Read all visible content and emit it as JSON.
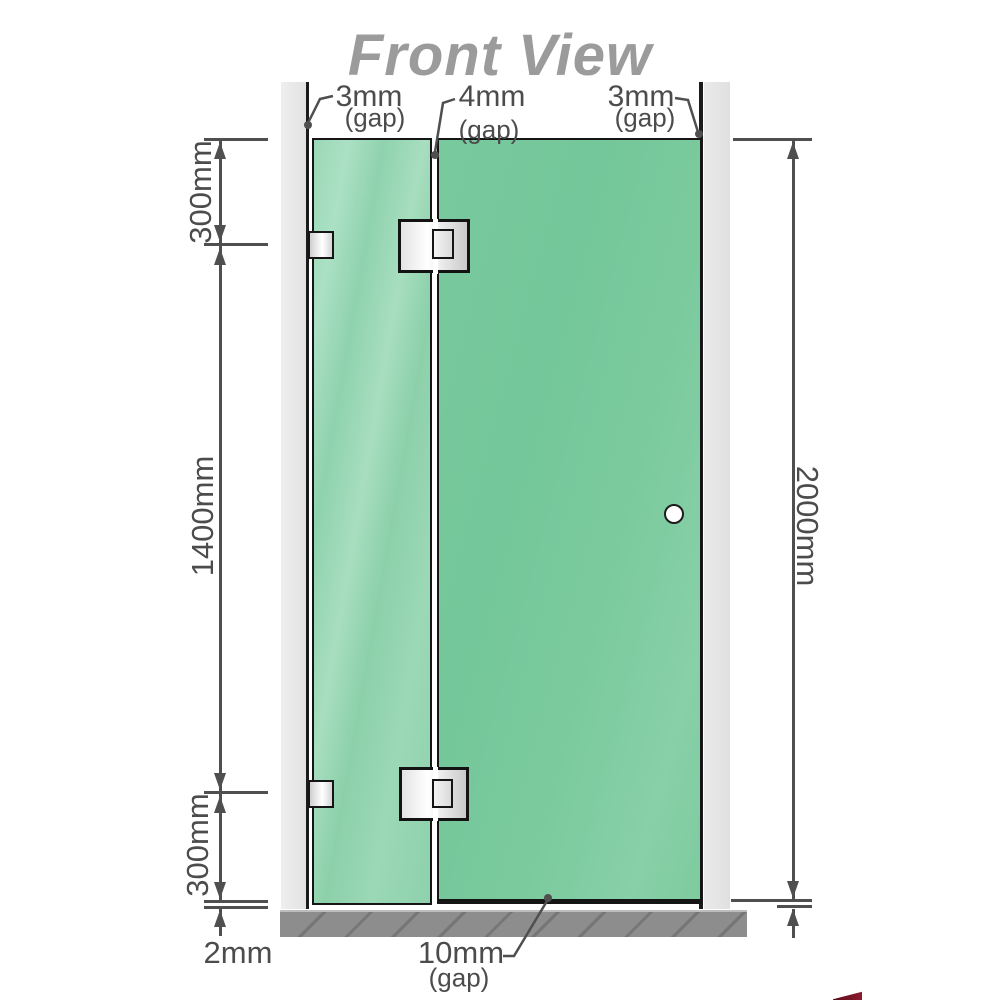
{
  "title": "Front View",
  "gaps": {
    "top_left": {
      "value": "3mm",
      "note": "(gap)"
    },
    "top_middle": {
      "value": "4mm",
      "note": "(gap)"
    },
    "top_right": {
      "value": "3mm",
      "note": "(gap)"
    },
    "bottom": {
      "value": "10mm",
      "note": "(gap)"
    },
    "floor": {
      "value": "2mm"
    }
  },
  "dimensions": {
    "upper_section": "300mm",
    "middle_section": "1400mm",
    "lower_section": "300mm",
    "overall_height": "2000mm"
  },
  "colors": {
    "glass_fixed": "#8fd2ae",
    "glass_door": "#77c89c",
    "wall_channel": "#e7e7e7",
    "outline": "#151515",
    "floor": "#8d8d8d",
    "dimension_lines": "#4f4f4f",
    "label_text": "#4c4c4c",
    "title_text": "#9b9b9b",
    "logo_red": "#8c1b2e"
  }
}
